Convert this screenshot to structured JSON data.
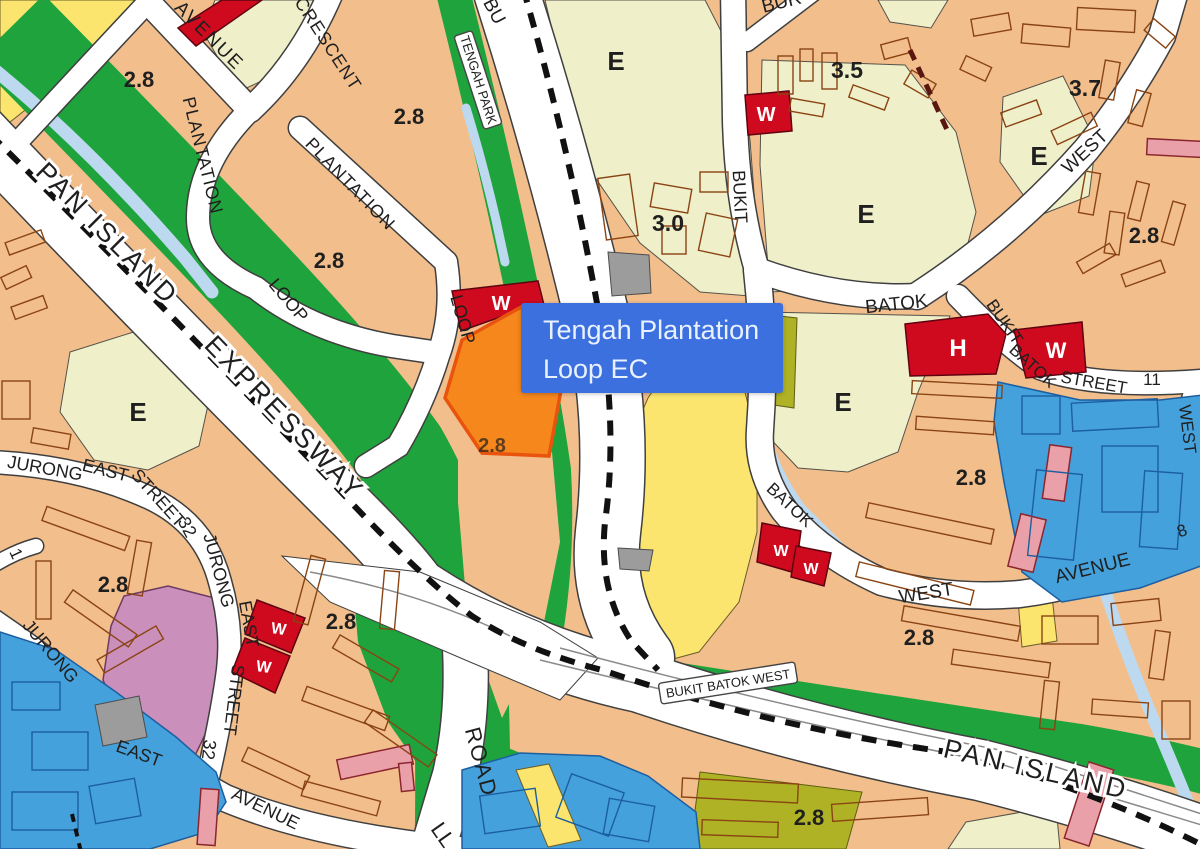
{
  "map": {
    "tooltip": {
      "line1": "Tengah Plantation",
      "line2": "Loop EC"
    },
    "colors": {
      "base_orange": "#F2BE8C",
      "cream": "#EFEFC9",
      "yellow": "#FBE56E",
      "green": "#1FA33C",
      "canal_blue": "#BCD9F0",
      "zone_blue": "#44A1DB",
      "blue_outline": "#1C5FA0",
      "mauve": "#CB8FBB",
      "gray": "#9C9C9C",
      "red": "#CF0A1E",
      "olive": "#AFB224",
      "pink": "#E9A0A8",
      "ec_orange": "#F6871C",
      "ec_border": "#E8540E",
      "building_outline": "#8A4413",
      "road_white": "#FFFFFF",
      "road_casing": "#3F3F3F",
      "mrt_dash": "#111111",
      "label_dark": "#1F1F1F",
      "tooltip_bg": "#3C70DF",
      "tooltip_text": "#E9F1FF"
    },
    "boxed_labels": [
      {
        "t": "TENGAH PARK",
        "x": 478,
        "y": 80,
        "r": 72,
        "w": 98,
        "h": 19,
        "s": 13
      },
      {
        "t": "BUKIT BATOK WEST",
        "x": 728,
        "y": 683,
        "r": -9,
        "w": 138,
        "h": 21,
        "s": 13
      }
    ],
    "labels": [
      {
        "t": "AVENUE",
        "x": 205,
        "y": 40,
        "r": 45,
        "s": 19,
        "ls": 2
      },
      {
        "t": "CRESCENT",
        "x": 323,
        "y": 47,
        "r": 57,
        "s": 18,
        "ls": 1
      },
      {
        "t": "PLANTATION",
        "x": 197,
        "y": 157,
        "r": 76,
        "s": 18,
        "ls": 1
      },
      {
        "t": "PLANTATION",
        "x": 346,
        "y": 188,
        "r": 46,
        "s": 18,
        "ls": 1
      },
      {
        "t": "PAN ISLAND",
        "x": 101,
        "y": 240,
        "r": 45,
        "s": 27,
        "ls": 3,
        "halo": true
      },
      {
        "t": "EXPRESSWAY",
        "x": 278,
        "y": 424,
        "r": 46,
        "s": 27,
        "ls": 3,
        "halo": true
      },
      {
        "t": "LOOP",
        "x": 284,
        "y": 304,
        "r": 50,
        "s": 18
      },
      {
        "t": "LOOP",
        "x": 457,
        "y": 321,
        "r": 74,
        "s": 18
      },
      {
        "t": "BU",
        "x": 489,
        "y": 14,
        "r": 62,
        "s": 19
      },
      {
        "t": "BUR",
        "x": 783,
        "y": 8,
        "r": -14,
        "s": 19
      },
      {
        "t": "E",
        "x": 616,
        "y": 70,
        "s": 26,
        "b": true
      },
      {
        "t": "3.0",
        "x": 668,
        "y": 231,
        "s": 23,
        "b": true
      },
      {
        "t": "BUKIT",
        "x": 734,
        "y": 197,
        "r": 87,
        "s": 18
      },
      {
        "t": "W",
        "x": 766,
        "y": 121,
        "s": 20,
        "b": true,
        "c": "white"
      },
      {
        "t": "3.5",
        "x": 847,
        "y": 78,
        "s": 23,
        "b": true
      },
      {
        "t": "3.7",
        "x": 1085,
        "y": 96,
        "s": 23,
        "b": true
      },
      {
        "t": "E",
        "x": 866,
        "y": 223,
        "s": 26,
        "b": true
      },
      {
        "t": "E",
        "x": 1039,
        "y": 165,
        "s": 26,
        "b": true
      },
      {
        "t": "WEST",
        "x": 1089,
        "y": 156,
        "r": -43,
        "s": 19
      },
      {
        "t": "2.8",
        "x": 1144,
        "y": 243,
        "s": 22,
        "b": true
      },
      {
        "t": "E",
        "x": 843,
        "y": 411,
        "s": 26,
        "b": true
      },
      {
        "t": "BATOK",
        "x": 897,
        "y": 310,
        "r": -6,
        "s": 19
      },
      {
        "t": "H",
        "x": 958,
        "y": 356,
        "s": 24,
        "b": true,
        "c": "white"
      },
      {
        "t": "W",
        "x": 1056,
        "y": 358,
        "s": 22,
        "b": true,
        "c": "white"
      },
      {
        "t": "BUKIT",
        "x": 1000,
        "y": 325,
        "r": 55,
        "s": 17
      },
      {
        "t": "BATOK",
        "x": 1029,
        "y": 370,
        "r": 42,
        "s": 17
      },
      {
        "t": "STREET",
        "x": 1093,
        "y": 388,
        "r": 10,
        "s": 17
      },
      {
        "t": "11",
        "x": 1152,
        "y": 385,
        "r": 0,
        "s": 17
      },
      {
        "t": "WEST",
        "x": 1182,
        "y": 430,
        "r": 83,
        "s": 17
      },
      {
        "t": "2.8",
        "x": 971,
        "y": 485,
        "s": 22,
        "b": true
      },
      {
        "t": "BATOK",
        "x": 786,
        "y": 509,
        "r": 43,
        "s": 17
      },
      {
        "t": "W",
        "x": 781,
        "y": 556,
        "s": 16,
        "b": true,
        "c": "white"
      },
      {
        "t": "W",
        "x": 811,
        "y": 574,
        "s": 16,
        "b": true,
        "c": "white"
      },
      {
        "t": "WEST",
        "x": 927,
        "y": 599,
        "r": -9,
        "s": 19
      },
      {
        "t": "AVENUE",
        "x": 1094,
        "y": 574,
        "r": -14,
        "s": 19
      },
      {
        "t": "8",
        "x": 1184,
        "y": 536,
        "r": -20,
        "s": 17
      },
      {
        "t": "2.8",
        "x": 919,
        "y": 645,
        "s": 22,
        "b": true
      },
      {
        "t": "2.8",
        "x": 809,
        "y": 825,
        "s": 22,
        "b": true
      },
      {
        "t": "PAN ISLAND",
        "x": 1034,
        "y": 778,
        "r": 13,
        "s": 27,
        "ls": 3,
        "halo": true
      },
      {
        "t": "2.8",
        "x": 113,
        "y": 592,
        "s": 22,
        "b": true
      },
      {
        "t": "2.8",
        "x": 341,
        "y": 629,
        "s": 22,
        "b": true
      },
      {
        "t": "E",
        "x": 138,
        "y": 421,
        "s": 26,
        "b": true
      },
      {
        "t": "JURONG",
        "x": 44,
        "y": 474,
        "r": 10,
        "s": 18
      },
      {
        "t": "EAST",
        "x": 104,
        "y": 476,
        "r": 14,
        "s": 18
      },
      {
        "t": "STREET",
        "x": 154,
        "y": 502,
        "r": 48,
        "s": 18
      },
      {
        "t": "32",
        "x": 182,
        "y": 530,
        "r": 62,
        "s": 18
      },
      {
        "t": "JURONG",
        "x": 213,
        "y": 572,
        "r": 75,
        "s": 18
      },
      {
        "t": "EAST",
        "x": 243,
        "y": 625,
        "r": 80,
        "s": 18
      },
      {
        "t": "STREET",
        "x": 228,
        "y": 699,
        "r": 97,
        "s": 18
      },
      {
        "t": "32",
        "x": 203,
        "y": 749,
        "r": 97,
        "s": 18
      },
      {
        "t": "JURONG",
        "x": 46,
        "y": 655,
        "r": 50,
        "s": 18
      },
      {
        "t": "EAST",
        "x": 137,
        "y": 759,
        "r": 20,
        "s": 18
      },
      {
        "t": "AVENUE",
        "x": 263,
        "y": 814,
        "r": 26,
        "s": 18
      },
      {
        "t": "1",
        "x": 11,
        "y": 556,
        "r": 65,
        "s": 17
      },
      {
        "t": "ROAD",
        "x": 474,
        "y": 764,
        "r": 75,
        "s": 22,
        "ls": 2
      },
      {
        "t": "LL",
        "x": 437,
        "y": 839,
        "r": 55,
        "s": 22
      },
      {
        "t": "W",
        "x": 501,
        "y": 310,
        "s": 20,
        "b": true,
        "c": "white"
      },
      {
        "t": "2.8",
        "x": 492,
        "y": 452,
        "s": 20,
        "b": true,
        "o": 0.7
      },
      {
        "t": "2.8",
        "x": 139,
        "y": 87,
        "s": 22,
        "b": true
      },
      {
        "t": "2.8",
        "x": 409,
        "y": 124,
        "s": 22,
        "b": true
      },
      {
        "t": "2.8",
        "x": 329,
        "y": 268,
        "s": 22,
        "b": true
      },
      {
        "t": "W",
        "x": 278,
        "y": 634,
        "r": 8,
        "s": 16,
        "b": true,
        "c": "white"
      },
      {
        "t": "W",
        "x": 263,
        "y": 672,
        "r": 8,
        "s": 16,
        "b": true,
        "c": "white"
      }
    ]
  }
}
